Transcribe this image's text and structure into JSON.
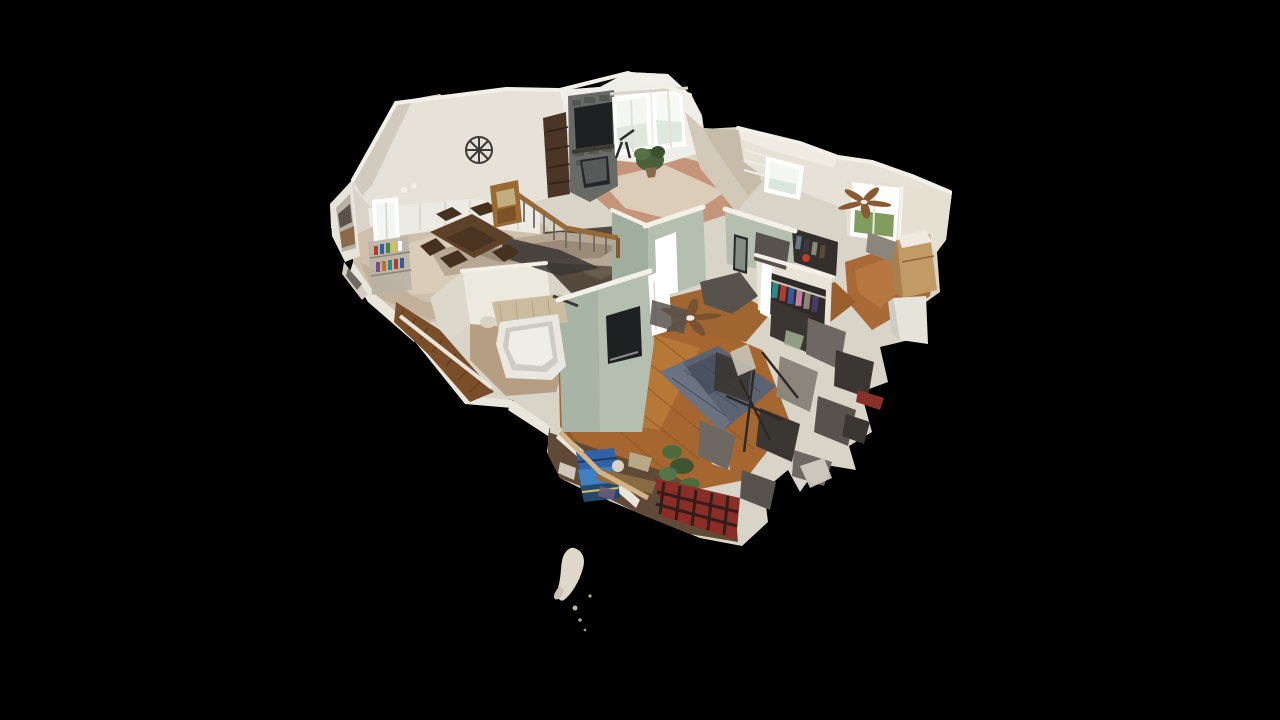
{
  "viewer": {
    "name": "3d-home-tour-viewer",
    "view_mode": "dollhouse",
    "visible_text": [],
    "background": "#000000"
  },
  "scene": {
    "type": "residential-3d-scan-dollhouse",
    "camera": "elevated three-quarter overhead view, house floats on black",
    "palette": {
      "background": "#000000",
      "wall_light": "#e6e2d8",
      "wall_mid": "#d8d4c8",
      "wall_shadow": "#c2bcae",
      "wall_sage": "#b4bfb0",
      "floor_tile": "#cfc0ac",
      "floor_tile_warm": "#c49579",
      "area_rug": "#dccdb9",
      "floor_wood": "#a5672f",
      "floor_wood_dark": "#7e4c20",
      "stairs_wood": "#7a4e28",
      "railing_oak": "#9a6a35",
      "fireplace_stone": "#686a66",
      "tv_black": "#1e2022",
      "bed_blue": "#5b6372",
      "tub_white": "#e9e7e0",
      "plant_green": "#49613a",
      "window_glow": "#f4f6f1",
      "outdoor_green": "#7e9d5e",
      "cardboard_box": "#c29a66",
      "storage_bin_blue": "#2f62a8",
      "plaid_blanket_red": "#8a2d26",
      "scan_glitch_dark": "#3a3631"
    },
    "rooms": [
      {
        "name": "living-room",
        "floor": "tile with area rug",
        "features": [
          "stone fireplace column",
          "wall-mounted tv",
          "bay windows",
          "potted plant",
          "telescope",
          "bookshelf"
        ]
      },
      {
        "name": "dining-room",
        "floor": "marble tile",
        "features": [
          "wood dining table",
          "chairs",
          "bar cart with bottles",
          "wainscoting wall",
          "wheel wall decor",
          "front door",
          "window with curtain"
        ]
      },
      {
        "name": "kitchen",
        "floor": "tile",
        "features": [
          "granite counter",
          "dark cabinets",
          "scan shadow artifacts"
        ]
      },
      {
        "name": "stairwell",
        "floor": "wood stairs",
        "features": [
          "oak banister with balusters",
          "white stair rail",
          "lower staircase to basement"
        ]
      },
      {
        "name": "bathroom",
        "floor": "stone tile",
        "features": [
          "white bathtub",
          "tile tub surround",
          "towel bar"
        ]
      },
      {
        "name": "master-bedroom",
        "floor": "hardwood",
        "features": [
          "blue-gray bed",
          "ceiling fan",
          "wall-mounted tv on sage wall",
          "white doors",
          "floor plant",
          "walk-in closet with hanging clothes"
        ]
      },
      {
        "name": "bedroom-2",
        "floor": "hardwood",
        "features": [
          "ceiling fan",
          "window with lawn view",
          "cardboard moving box",
          "closet with clothes",
          "white dresser"
        ]
      },
      {
        "name": "laundry-hall",
        "floor": "hardwood",
        "features": [
          "bright windows",
          "wire shelving",
          "sage green walls",
          "framed mirror"
        ]
      },
      {
        "name": "basement-cutaway",
        "floor": "concrete/clutter",
        "features": [
          "blue storage bins",
          "red plaid blanket",
          "shelving clutter",
          "white bucket"
        ]
      },
      {
        "name": "scan-artifacts",
        "features": [
          "jagged dark mesh fragments along right and bottom edges",
          "small floating white mesh fragment below house"
        ]
      }
    ]
  }
}
